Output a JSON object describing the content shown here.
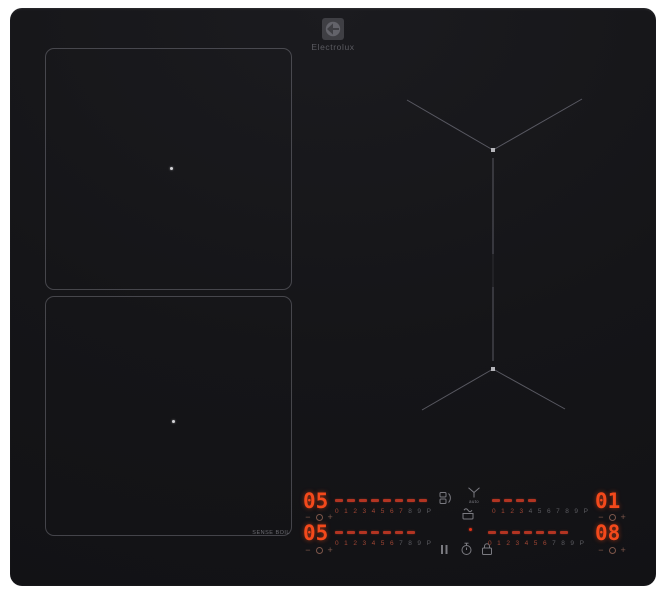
{
  "brand": {
    "name": "Electrolux"
  },
  "labels": {
    "sense_boil": "SENSE BOIL",
    "hob2hood_auto": "auto"
  },
  "timer_keys": {
    "minus": "−",
    "plus": "+"
  },
  "slider_scale": [
    "0",
    "1",
    "2",
    "3",
    "4",
    "5",
    "6",
    "7",
    "8",
    "9",
    "P"
  ],
  "zones": {
    "left_top": {
      "power_display": "05",
      "lit_dashes": 8,
      "lit_scale": 8
    },
    "left_bottom": {
      "power_display": "05",
      "lit_dashes": 7,
      "lit_scale": 7
    },
    "right_top": {
      "power_display": "01",
      "lit_dashes": 4,
      "lit_scale": 4
    },
    "right_bottom": {
      "power_display": "08",
      "lit_dashes": 7,
      "lit_scale": 7
    }
  },
  "icons": [
    "bridge",
    "hob2hood",
    "sense-boil-pot",
    "pause",
    "stopwatch",
    "lock",
    "timer-clock"
  ],
  "colors": {
    "display_red": "#f4491b",
    "dash_red": "#b23422",
    "surface_black": "#17171a",
    "zone_line_gray": "#60606a"
  }
}
